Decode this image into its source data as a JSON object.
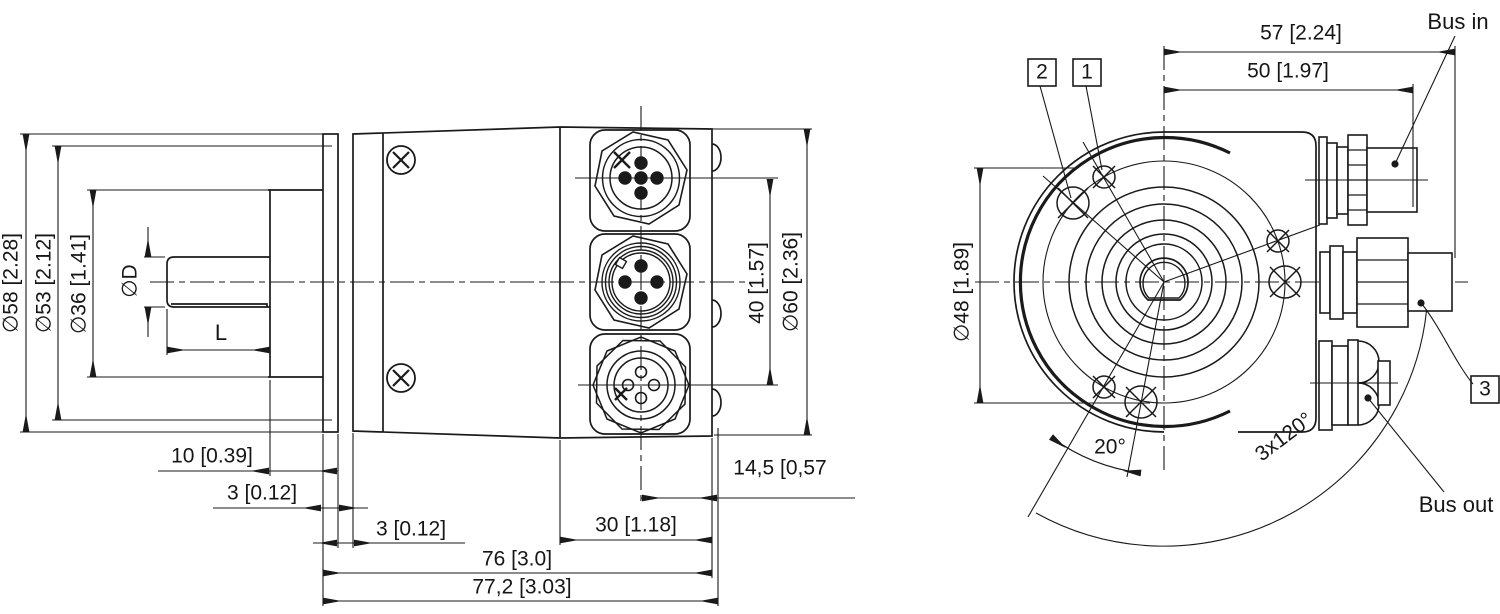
{
  "drawing": {
    "kind": "encoder dimensional drawing",
    "views": {
      "side": "side view with M12 connectors",
      "front": "rear view with bus connectors"
    }
  },
  "side_view": {
    "dia58": "∅58 [2.28]",
    "dia53": "∅53 [2.12]",
    "dia36": "∅36 [1.41]",
    "shaft_dia": "∅D",
    "shaft_len": "L",
    "len10": "10 [0.39]",
    "flange_3": "3 [0.12]",
    "gap_3": "3 [0.12]",
    "len30": "30 [1.18]",
    "len76": "76 [3.0]",
    "len77_2": "77,2 [3.03]",
    "len14_5": "14,5 [0,57",
    "span40": "40 [1.57]",
    "dia60": "∅60 [2.36]"
  },
  "front_view": {
    "len57": "57 [2.24]",
    "len50": "50 [1.97]",
    "dia48": "∅48 [1.89]",
    "angle20": "20°",
    "angle120": "3x120°",
    "bus_in": "Bus in",
    "bus_out": "Bus out",
    "callout1": "1",
    "callout2": "2",
    "callout3": "3"
  },
  "colors": {
    "line": "#1a1a1a",
    "background": "#ffffff"
  }
}
